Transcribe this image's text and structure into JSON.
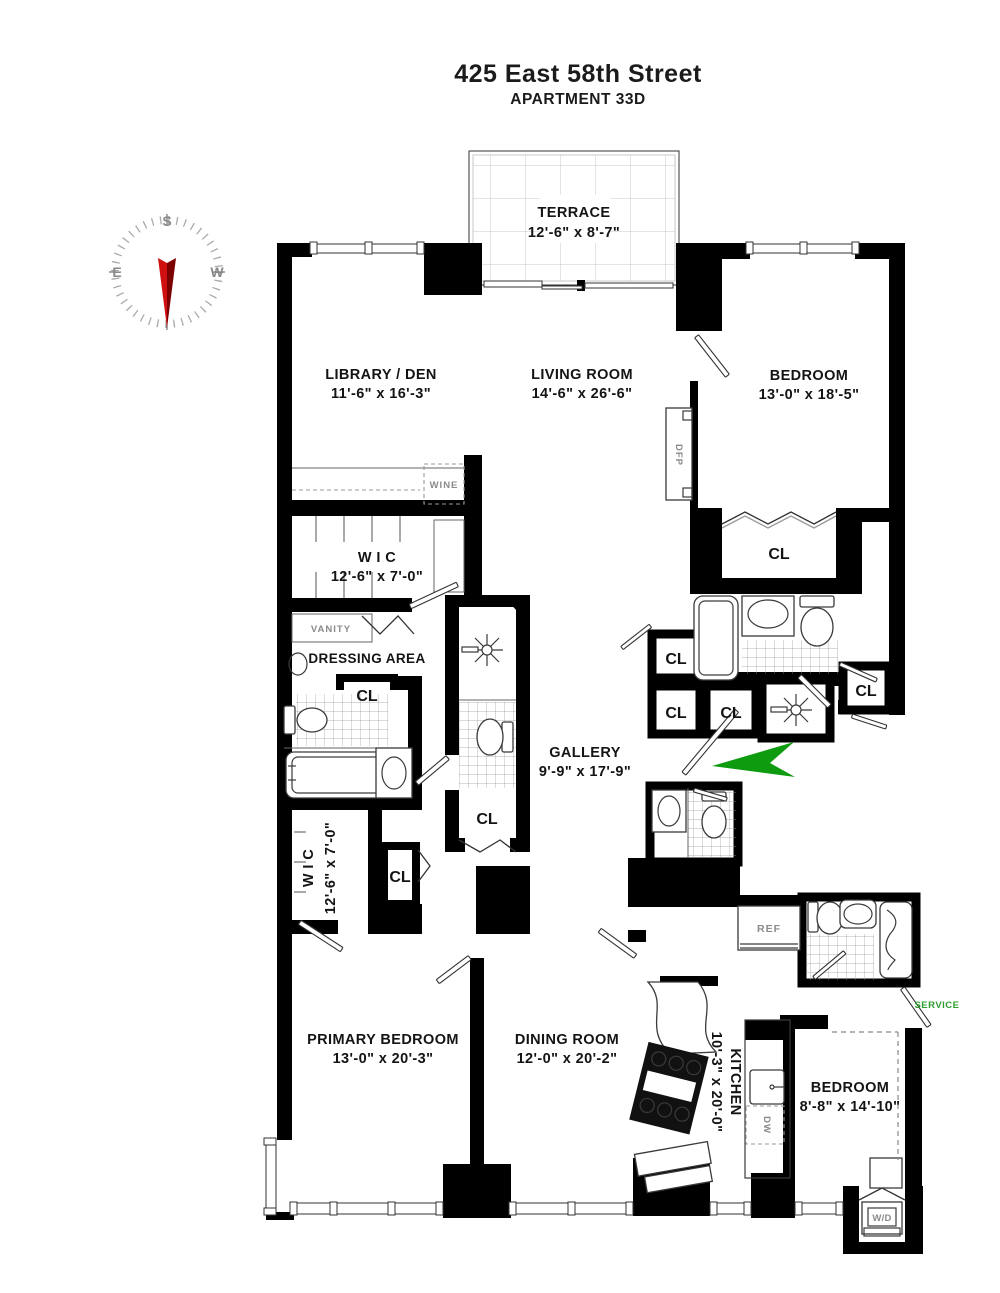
{
  "title": "425 East 58th Street",
  "subtitle": "APARTMENT 33D",
  "compass": {
    "top": "S",
    "left": "E",
    "right": "W"
  },
  "rooms": {
    "terrace": {
      "name": "TERRACE",
      "dims": "12'-6\" x 8'-7\""
    },
    "library_den": {
      "name": "LIBRARY / DEN",
      "dims": "11'-6\" x 16'-3\""
    },
    "living_room": {
      "name": "LIVING ROOM",
      "dims": "14'-6\" x 26'-6\""
    },
    "bedroom_top": {
      "name": "BEDROOM",
      "dims": "13'-0\" x 18'-5\""
    },
    "wic_upper": {
      "name": "W I C",
      "dims": "12'-6\" x 7'-0\""
    },
    "dressing_area": {
      "name": "DRESSING AREA"
    },
    "wic_lower": {
      "name": "W I C",
      "dims": "12'-6\" x 7'-0\""
    },
    "gallery": {
      "name": "GALLERY",
      "dims": "9'-9\" x 17'-9\""
    },
    "primary_bedroom": {
      "name": "PRIMARY BEDROOM",
      "dims": "13'-0\" x 20'-3\""
    },
    "dining_room": {
      "name": "DINING ROOM",
      "dims": "12'-0\" x 20'-2\""
    },
    "kitchen": {
      "name": "KITCHEN",
      "dims": "10'-3\" x 20'-0\""
    },
    "bedroom_small": {
      "name": "BEDROOM",
      "dims": "8'-8\" x 14'-10\""
    }
  },
  "labels": {
    "closet": "CL",
    "vanity": "VANITY",
    "wine": "WINE",
    "dfp": "DFP",
    "ref": "REF",
    "dw": "DW",
    "washer_dryer": "W/D",
    "service": "SERVICE"
  },
  "colors": {
    "wall": "#000000",
    "compass_needle": "#d01010",
    "compass_needle_dark": "#7d0000",
    "entry_arrow": "#0f9b0f",
    "service_text": "#2ea02e"
  }
}
